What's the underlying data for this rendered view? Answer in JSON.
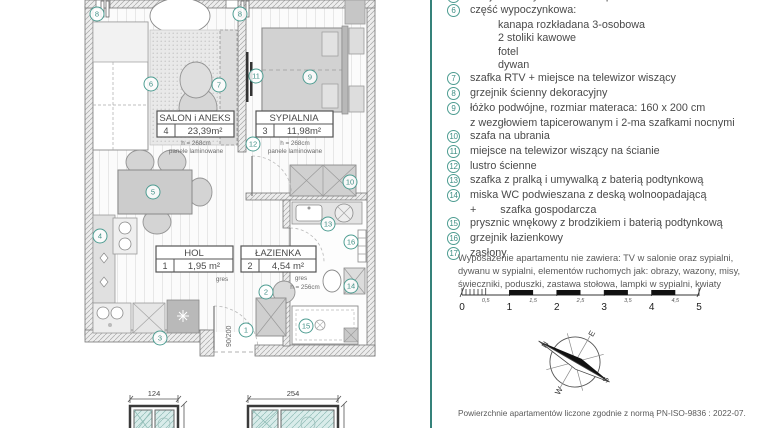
{
  "accent": {
    "teal_circle": "#4E9D92",
    "teal_text": "#3F8F85",
    "divider": "#35827A",
    "glass": "#D9ECEA"
  },
  "plan": {
    "rooms": [
      {
        "name": "SALON i ANEKS",
        "number": "4",
        "area": "23,39m²",
        "height_note": "h = 268cm",
        "floor_note": "panele laminowane"
      },
      {
        "name": "SYPIALNIA",
        "number": "3",
        "area": "11,98m²",
        "height_note": "h = 268cm",
        "floor_note": "panele laminowane"
      },
      {
        "name": "HOL",
        "number": "1",
        "area": "1,95 m²",
        "floor_note": "gres"
      },
      {
        "name": "ŁAZIENKA",
        "number": "2",
        "area": "4,54 m²",
        "floor_note": "gres",
        "height_note": "h = 256cm"
      }
    ],
    "markers": [
      "8",
      "8",
      "6",
      "7",
      "11",
      "9",
      "12",
      "5",
      "4",
      "10",
      "13",
      "16",
      "2",
      "14",
      "1",
      "15",
      "3"
    ],
    "door_dim": "90/200",
    "window_dims": {
      "left": "124",
      "right": "254"
    }
  },
  "legend": {
    "truncated_n": "5",
    "truncated_item": "stół jadalniany + 4 krzesła tapicerowane",
    "items": [
      {
        "n": "6",
        "text": "część wypoczynkowa:",
        "sub": [
          "kanapa rozkładana 3-osobowa",
          "2 stoliki kawowe",
          "fotel",
          "dywan"
        ]
      },
      {
        "n": "7",
        "text": "szafka RTV + miejsce na telewizor wiszący"
      },
      {
        "n": "8",
        "text": "grzejnik ścienny dekoracyjny"
      },
      {
        "n": "9",
        "text": "łóżko podwójne, rozmiar materaca: 160 x 200 cm",
        "text2": "z wezgłowiem tapicerowanym i 2-ma szafkami nocnymi"
      },
      {
        "n": "10",
        "text": "szafa na ubrania"
      },
      {
        "n": "11",
        "text": "miejsce na telewizor wiszący na ścianie"
      },
      {
        "n": "12",
        "text": "lustro ścienne"
      },
      {
        "n": "13",
        "text": "szafka z pralką i umywalką z baterią podtynkową"
      },
      {
        "n": "14",
        "text": "miska WC podwieszana z deską  wolnoopadającą",
        "text2": "+        szafka gospodarcza"
      },
      {
        "n": "15",
        "text": "prysznic wnękowy z brodzikiem i baterią podtynkową"
      },
      {
        "n": "16",
        "text": "grzejnik łazienkowy"
      },
      {
        "n": "17",
        "text": "zasłony"
      }
    ]
  },
  "note": {
    "text": "Wyposażenie apartamentu nie zawiera: TV w salonie oraz sypialni, dywanu w sypialni, elementów ruchomych jak: obrazy, wazony, misy, świeczniki, poduszki, zastawa stołowa, lampki w sypialni, kwiaty"
  },
  "scalebar": {
    "major": [
      "0",
      "1",
      "2",
      "3",
      "4",
      "5"
    ],
    "minor": [
      "0,5",
      "1,5",
      "2,5",
      "3,5",
      "4,5"
    ]
  },
  "compass": {
    "n": "N",
    "e": "E",
    "s": "S",
    "w": "W"
  },
  "footer": {
    "text": "Powierzchnie apartamentów liczone zgodnie z normą PN-ISO-9836 : 2022-07."
  }
}
